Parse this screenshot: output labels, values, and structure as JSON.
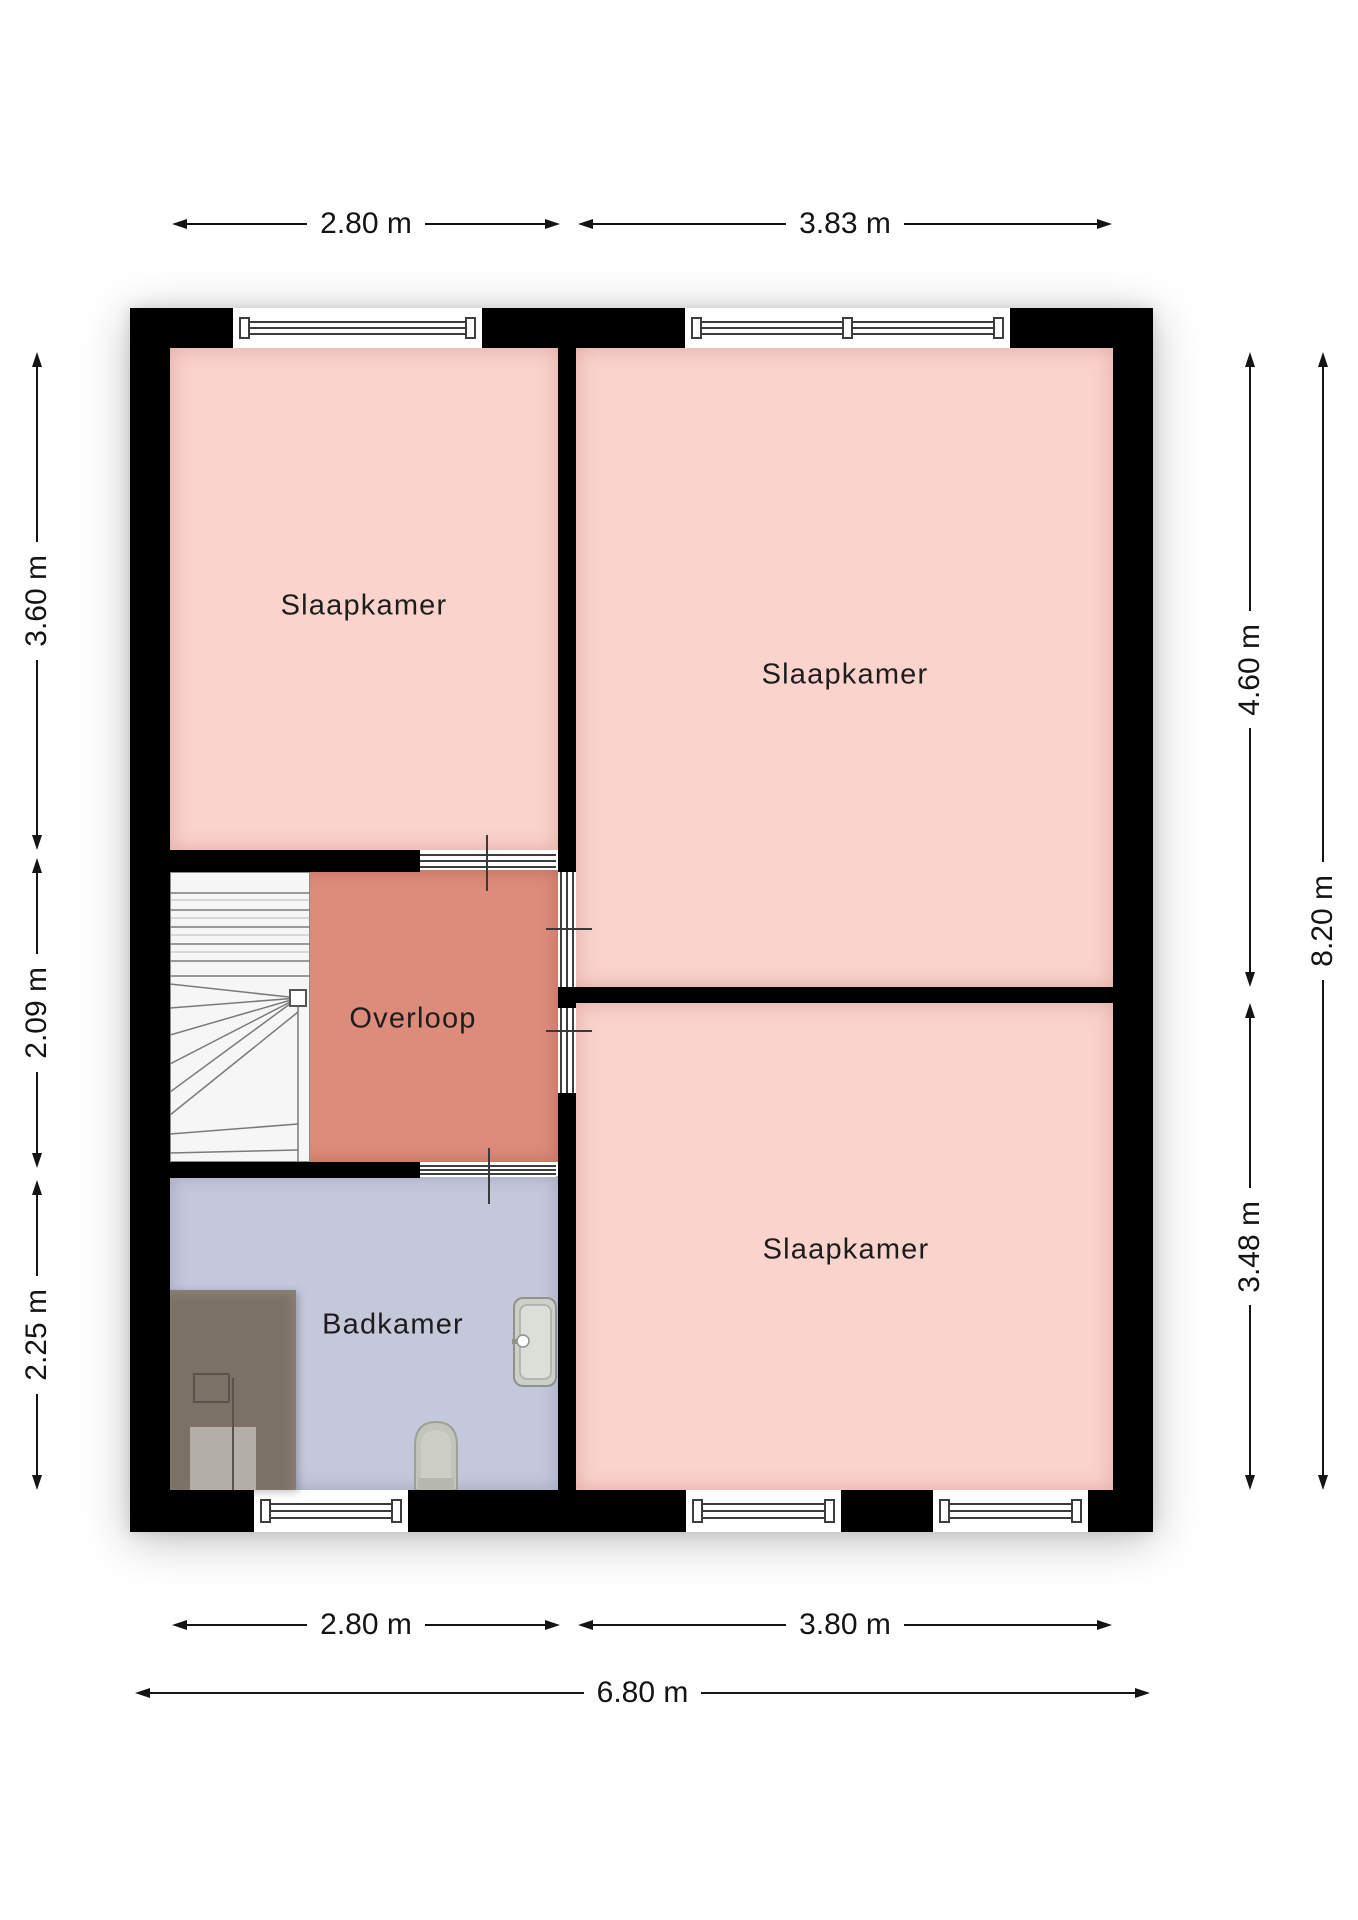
{
  "floorplan": {
    "rooms": {
      "bedroom_top_left": {
        "label": "Slaapkamer"
      },
      "bedroom_top_right": {
        "label": "Slaapkamer"
      },
      "bedroom_bottom_right": {
        "label": "Slaapkamer"
      },
      "landing": {
        "label": "Overloop"
      },
      "bathroom": {
        "label": "Badkamer"
      }
    },
    "dimensions": {
      "top": [
        {
          "label": "2.80 m"
        },
        {
          "label": "3.83 m"
        }
      ],
      "left": [
        {
          "label": "3.60 m"
        },
        {
          "label": "2.09 m"
        },
        {
          "label": "2.25 m"
        }
      ],
      "right": [
        {
          "label": "4.60 m"
        },
        {
          "label": "3.48 m"
        },
        {
          "label": "8.20 m"
        }
      ],
      "bottom": [
        {
          "label": "2.80 m"
        },
        {
          "label": "3.80 m"
        },
        {
          "label": "6.80 m"
        }
      ]
    },
    "colors": {
      "bedroom_floor": "#f9d3cc",
      "landing_floor": "#dd8b7a",
      "bathroom_floor": "#c5c7db",
      "wall": "#000000",
      "wardrobe": "#7b7166",
      "dimension_text": "#141414"
    },
    "fixtures": [
      "stairs",
      "wardrobe",
      "toilet",
      "sink"
    ]
  }
}
